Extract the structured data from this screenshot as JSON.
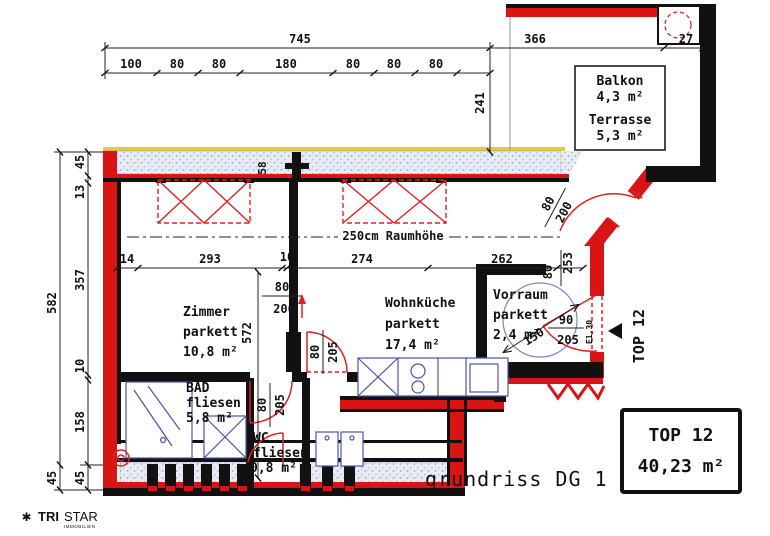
{
  "caption": "grundriss DG 1",
  "unit_box": {
    "line1": "TOP 12",
    "line2": "40,23 m²"
  },
  "side_label": "TOP 12",
  "balcony": {
    "room1": "Balkon",
    "area1": "4,3 m²",
    "room2": "Terrasse",
    "area2": "5,3 m²"
  },
  "rooms": {
    "zimmer": {
      "name": "Zimmer",
      "floor": "parkett",
      "area": "10,8 m²"
    },
    "wohnkueche": {
      "name": "Wohnküche",
      "floor": "parkett",
      "area": "17,4 m²"
    },
    "vorraum": {
      "name": "Vorraum",
      "floor": "parkett",
      "area": "2,4 m²"
    },
    "bad": {
      "name": "BAD",
      "floor": "fliesen",
      "area": "5,8 m²"
    },
    "wc": {
      "name": "WC",
      "floor": "fliesen",
      "area": "0,8 m²"
    }
  },
  "notes": {
    "room_height": "250cm Raumhöhe",
    "parapet": "E1,30"
  },
  "dims": {
    "total_width": "745",
    "w1": "100",
    "w2": "80",
    "w3": "80",
    "w4": "180",
    "w5": "80",
    "w6": "80",
    "w7": "80",
    "balcony_width": "366",
    "shaft_width": "27",
    "balcony_depth": "241",
    "total_height": "582",
    "bottom_outer": "45",
    "h1": "45",
    "h2": "13",
    "h3": "357",
    "h4": "10",
    "h5": "158",
    "h6": "45",
    "c1": "14",
    "c2": "293",
    "c3": "10",
    "c4": "274",
    "c5": "262",
    "c6": "80",
    "c7": "253",
    "wall_stub": "58",
    "niche_width": "80",
    "niche_depth": "206",
    "room_length": "572",
    "door_living_w": "80",
    "door_living_h": "205",
    "door_bad_w": "80",
    "door_bad_h": "205",
    "door_balcony_w": "80",
    "door_balcony_h": "200",
    "door_entry_w": "90",
    "door_entry_h": "205",
    "turning_radius": "150"
  },
  "logo": {
    "mark": "✱",
    "name_bold": "TRI",
    "name_light": "STAR",
    "subtitle": "IMMOBILIEN"
  },
  "colors": {
    "wall_red": "#d81414",
    "line_black": "#111111",
    "fixture_blue": "#4a55a8",
    "glass_band": "#e9ecf4",
    "accent_yellow": "#e3cc3a",
    "door_red": "#e02020"
  }
}
